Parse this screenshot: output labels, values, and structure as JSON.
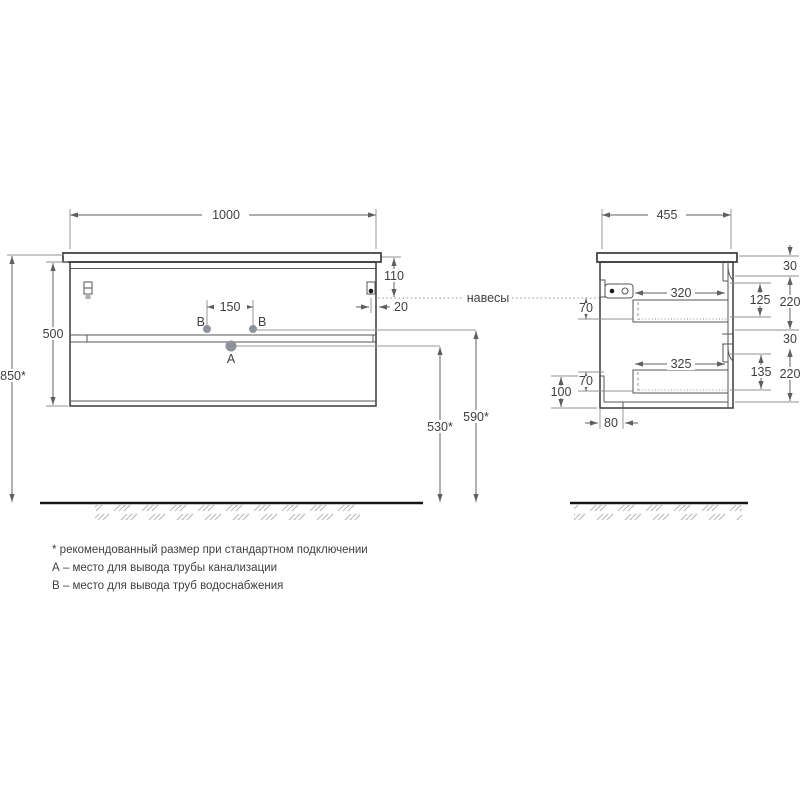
{
  "palette": {
    "background": "#ffffff",
    "outline": "#3a3a3a",
    "dim_line": "#5f5f5f",
    "text": "#3f3f44",
    "dot": "#8d929b",
    "floor": "#161616",
    "hatch": "#b5b5b5"
  },
  "front_view": {
    "dim_width": "1000",
    "dim_counter_to_hanger": "110",
    "dim_hanger_inset": "20",
    "dim_holes_spacing": "150",
    "dim_body_height": "500",
    "dim_mount_height": "850*",
    "dim_b_to_floor": "590*",
    "dim_a_to_floor": "530*",
    "label_point_a": "A",
    "label_point_b_left": "B",
    "label_point_b_right": "B"
  },
  "side_view": {
    "dim_depth": "455",
    "dim_top_gap": "30",
    "dim_drawer1_opening": "125",
    "dim_drawer1_front": "220",
    "dim_drawer1_depth": "320",
    "dim_hanger_drop": "70",
    "dim_mid_gap": "30",
    "dim_drawer2_opening": "135",
    "dim_drawer2_front": "220",
    "dim_drawer2_depth": "325",
    "dim_bottom_offset": "70",
    "dim_recess_height": "100",
    "dim_recess_depth": "80"
  },
  "annotations": {
    "hangers": "навесы"
  },
  "footnotes": {
    "recommended": "* рекомендованный размер при стандартном подключении",
    "point_a": "А – место для вывода трубы канализации",
    "point_b": "В – место для вывода труб водоснабжения"
  }
}
